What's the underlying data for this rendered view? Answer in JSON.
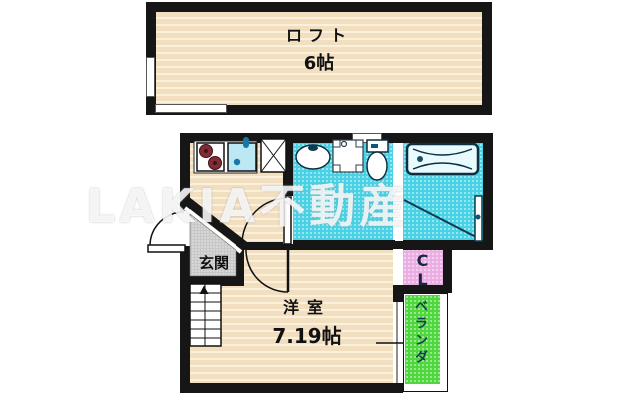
{
  "watermark": "LAKIA不動産",
  "loft": {
    "label": "ロフト",
    "size": "6帖"
  },
  "rooms": {
    "western_room": {
      "label": "洋室",
      "size": "7.19帖"
    },
    "entrance": {
      "label": "玄関"
    },
    "closet": {
      "label": "CL"
    },
    "veranda": {
      "label": "ベランダ"
    }
  },
  "fixtures": [
    "gas-stove",
    "kitchen-sink",
    "refrigerator-space",
    "washbasin",
    "washing-machine-pan",
    "toilet",
    "bathtub",
    "stairs-up",
    "entrance-door",
    "lavatory-door",
    "bathroom-door",
    "room-door"
  ],
  "colors": {
    "wall": "#161616",
    "floor_beige": "#f2dfc0",
    "wet_area_cyan": "#49d2e5",
    "veranda_green": "#4fd83e",
    "closet_pink": "#eaaee3",
    "entrance_gray": "#c7c7c7"
  }
}
